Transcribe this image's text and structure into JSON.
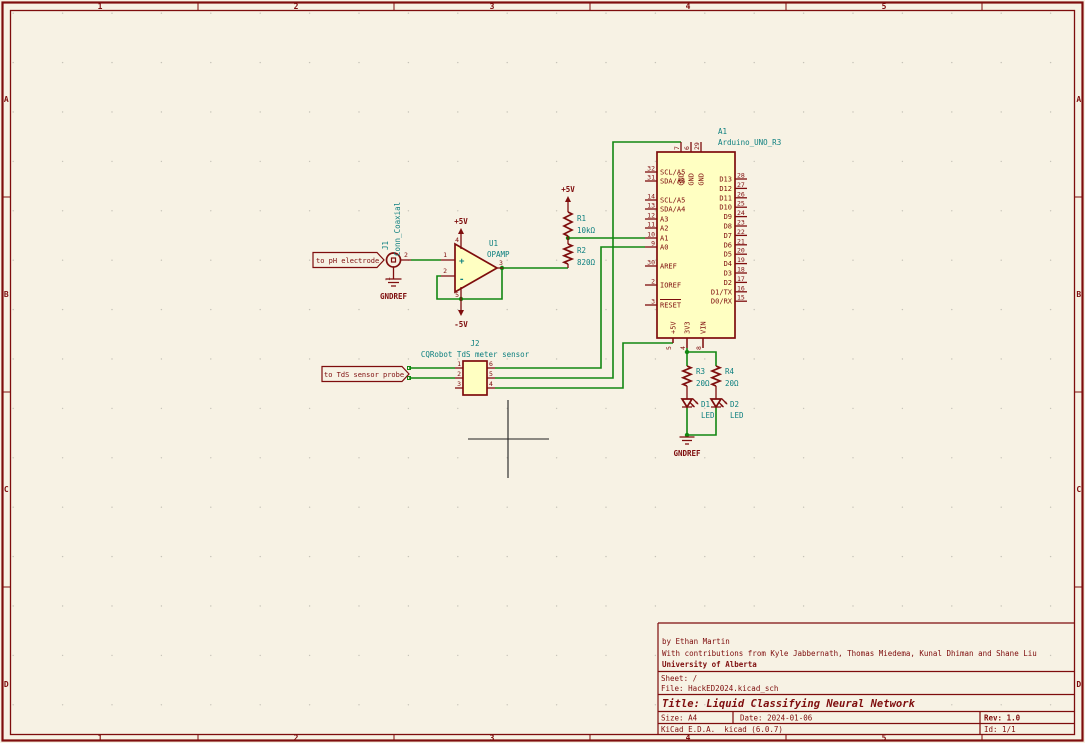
{
  "colors": {
    "background": "#F7F2E4",
    "outline": "#7E0D0D",
    "wire": "#128712",
    "accent_teal": "#0C7F7F",
    "fill_yellow": "#FFFFC2",
    "grid_dot": "#C6C3B8",
    "cursor": "#202020"
  },
  "frame": {
    "columns": [
      "1",
      "2",
      "3",
      "4",
      "5"
    ],
    "rows": [
      "A",
      "B",
      "C",
      "D"
    ]
  },
  "title_block": {
    "author_line": "by Ethan Martin",
    "contributors_line": "With contributions from Kyle Jabbernath, Thomas Miedema, Kunal Dhiman and Shane Liu",
    "organization": "University of Alberta",
    "sheet": "Sheet: /",
    "file": "File: HackED2024.kicad_sch",
    "title": "Title: Liquid Classifying Neural Network",
    "size": "Size: A4",
    "date": "Date: 2024-01-06",
    "rev": "Rev: 1.0",
    "tool": "KiCad E.D.A.  kicad (6.0.7)",
    "id": "Id: 1/1"
  },
  "power": {
    "plus5v": "+5V",
    "minus5v": "-5V",
    "gnd_ref": "GNDREF"
  },
  "net_labels": {
    "ph_electrode": "to pH electrode",
    "tds_probe": "to TdS sensor probe"
  },
  "components": {
    "j1": {
      "ref": "J1",
      "value": "Conn_Coaxial",
      "pin_numbers": [
        "2",
        "1"
      ]
    },
    "u1": {
      "ref": "U1",
      "value": "OPAMP",
      "plus": "+",
      "minus": "-",
      "pin_numbers": [
        "1",
        "2",
        "3",
        "4",
        "5"
      ]
    },
    "r1": {
      "ref": "R1",
      "value": "10kΩ"
    },
    "r2": {
      "ref": "R2",
      "value": "820Ω"
    },
    "r3": {
      "ref": "R3",
      "value": "20Ω"
    },
    "r4": {
      "ref": "R4",
      "value": "20Ω"
    },
    "d1": {
      "ref": "D1",
      "value": "LED"
    },
    "d2": {
      "ref": "D2",
      "value": "LED"
    },
    "j2": {
      "ref": "J2",
      "value": "CQRobot TdS meter sensor",
      "left_pin_numbers": [
        "1",
        "2",
        "3"
      ],
      "right_pin_numbers": [
        "6",
        "5",
        "4"
      ]
    },
    "a1": {
      "ref": "A1",
      "value": "Arduino_UNO_R3",
      "left_pins": [
        {
          "num": "32",
          "name": "SCL/A5"
        },
        {
          "num": "31",
          "name": "SDA/A4"
        },
        {
          "num": "14",
          "name": "SCL/A5"
        },
        {
          "num": "13",
          "name": "SDA/A4"
        },
        {
          "num": "12",
          "name": "A3"
        },
        {
          "num": "11",
          "name": "A2"
        },
        {
          "num": "10",
          "name": "A1"
        },
        {
          "num": "9",
          "name": "A0"
        },
        {
          "num": "30",
          "name": "AREF"
        },
        {
          "num": "2",
          "name": "IOREF"
        },
        {
          "num": "3",
          "name": "RESET"
        }
      ],
      "right_pins": [
        {
          "num": "28",
          "name": "D13"
        },
        {
          "num": "27",
          "name": "D12"
        },
        {
          "num": "26",
          "name": "D11"
        },
        {
          "num": "25",
          "name": "D10"
        },
        {
          "num": "24",
          "name": "D9"
        },
        {
          "num": "23",
          "name": "D8"
        },
        {
          "num": "22",
          "name": "D7"
        },
        {
          "num": "21",
          "name": "D6"
        },
        {
          "num": "20",
          "name": "D5"
        },
        {
          "num": "19",
          "name": "D4"
        },
        {
          "num": "18",
          "name": "D3"
        },
        {
          "num": "17",
          "name": "D2"
        },
        {
          "num": "16",
          "name": "D1/TX"
        },
        {
          "num": "15",
          "name": "D0/RX"
        }
      ],
      "top_pins": [
        {
          "num": "7",
          "name": "GND"
        },
        {
          "num": "6",
          "name": "GND"
        },
        {
          "num": "29",
          "name": "GND"
        }
      ],
      "bottom_pins": [
        {
          "num": "5",
          "name": "+5V"
        },
        {
          "num": "4",
          "name": "3V3"
        },
        {
          "num": "8",
          "name": "VIN"
        }
      ]
    }
  }
}
